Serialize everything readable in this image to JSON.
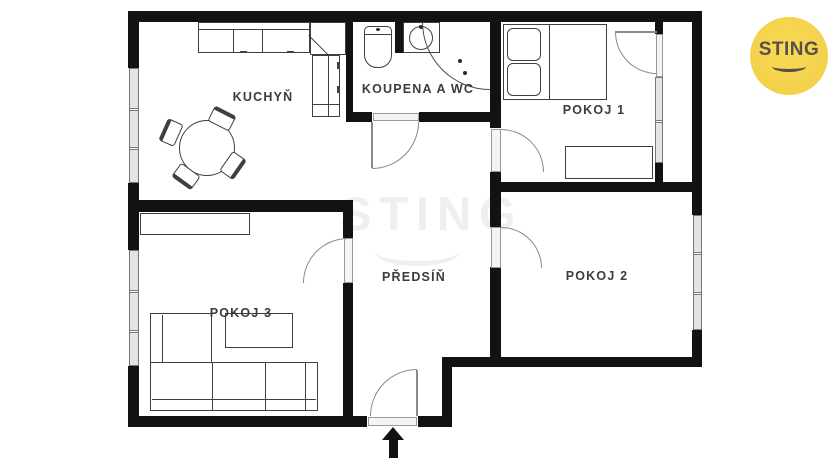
{
  "floorplan": {
    "rooms": [
      {
        "id": "kuchyn",
        "label": "KUCHYŇ"
      },
      {
        "id": "koupelna",
        "label": "KOUPENA A WC"
      },
      {
        "id": "pokoj1",
        "label": "POKOJ 1"
      },
      {
        "id": "pokoj2",
        "label": "POKOJ 2"
      },
      {
        "id": "pokoj3",
        "label": "POKOJ 3"
      },
      {
        "id": "predsin",
        "label": "PŘEDSÍŇ"
      }
    ]
  },
  "watermark": {
    "text": "STING"
  },
  "logo": {
    "text": "STING"
  },
  "colors": {
    "wall": "#121212",
    "furniture_line": "#3f3f3f",
    "door_arc": "#8a8a8a",
    "window_fill": "#e4e4e4",
    "logo_bg": "#f6d052",
    "logo_text": "#55524c",
    "watermark_gray": "#efefef"
  }
}
